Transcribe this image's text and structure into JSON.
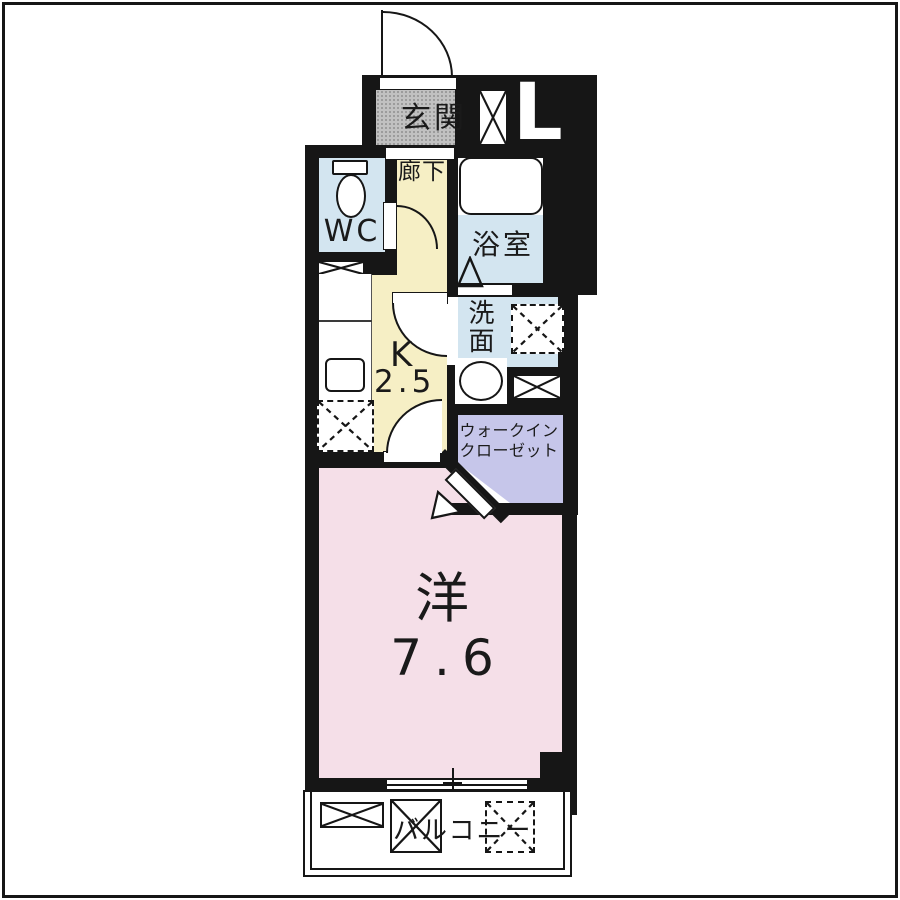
{
  "floorplan": {
    "entrance": {
      "label": "玄関"
    },
    "hallway": {
      "label": "廊下"
    },
    "toilet": {
      "label": "WC"
    },
    "bathroom": {
      "label": "浴室"
    },
    "washroom": {
      "label": "洗面"
    },
    "kitchen": {
      "letter": "K",
      "size": "2.5"
    },
    "closet": {
      "label": "ウォークイン\nクローゼット"
    },
    "room": {
      "type": "洋",
      "size": "7.6"
    },
    "balcony": {
      "label": "バルコニー"
    },
    "elevator": {
      "label": "L"
    }
  },
  "colors": {
    "wall": "#161616",
    "entrance_floor": "#c1c1c1",
    "hallway_kitchen_floor": "#f6efc5",
    "wet_area_floor": "#d3e5f0",
    "closet_floor": "#c6c6ea",
    "room_floor": "#f5dfe8",
    "fixture": "#ffffff"
  }
}
